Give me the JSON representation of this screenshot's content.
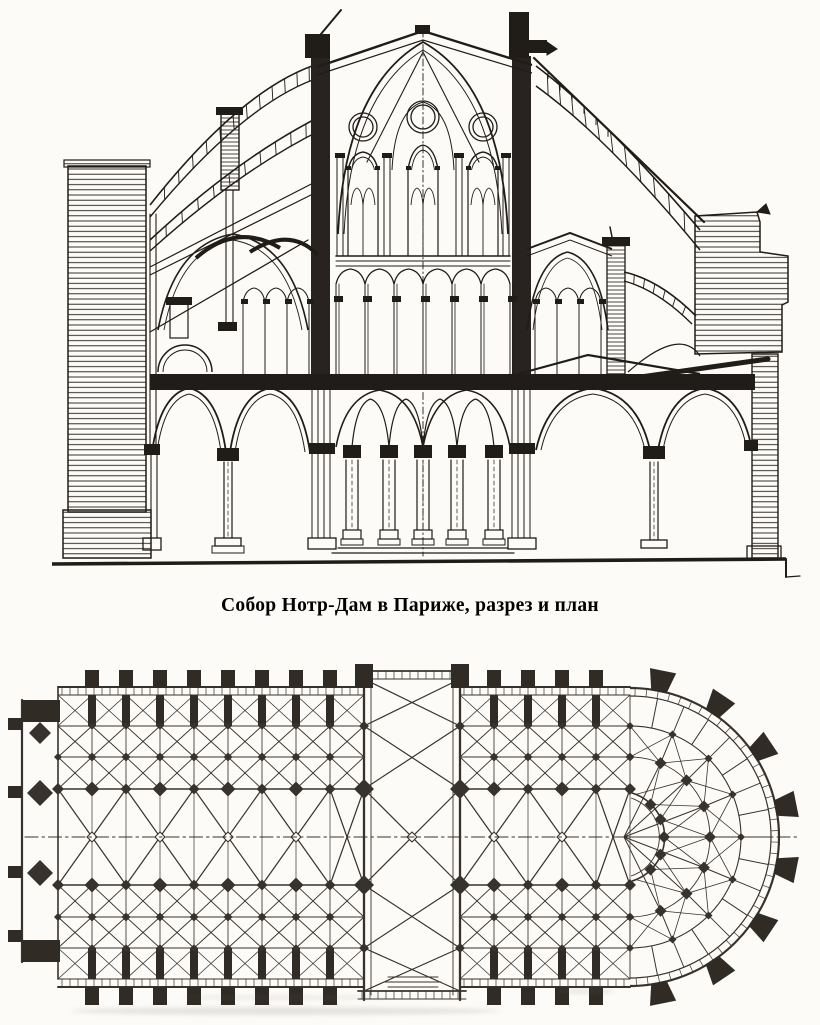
{
  "caption": {
    "text": "Собор Нотр-Дам в Париже, разрез и план"
  },
  "palette": {
    "paper": "#fcfbf8",
    "section_ink": "#201c18",
    "plan_ink": "#2d2823",
    "dark_fill": "#262019"
  },
  "graphics": {
    "section_icon": "cathedral-cross-section-drawing",
    "plan_icon": "cathedral-floor-plan-drawing"
  }
}
